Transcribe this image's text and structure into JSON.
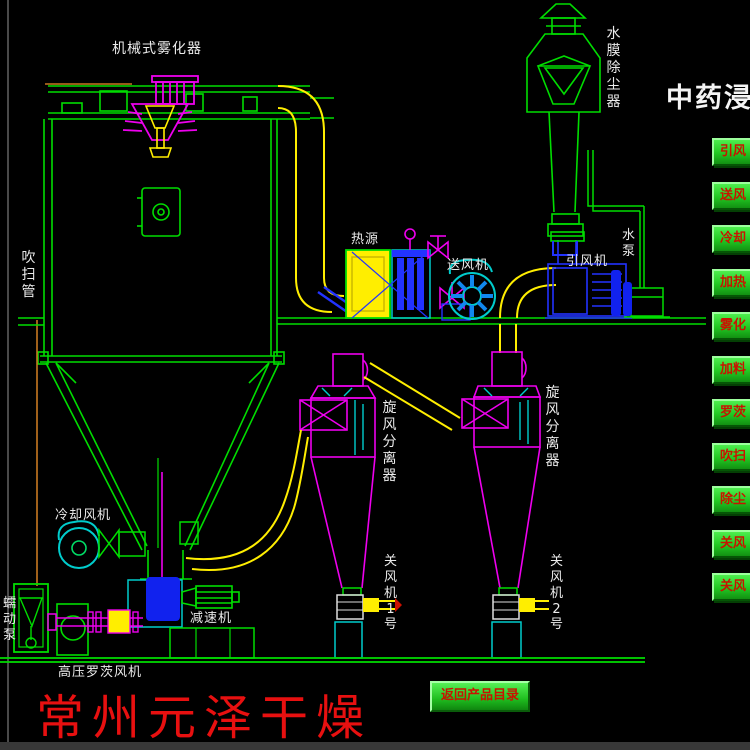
{
  "header": {
    "title": "中药浸膏"
  },
  "control_panel": {
    "items": [
      "引风",
      "送风",
      "冷却",
      "加热",
      "雾化",
      "加料",
      "罗茨",
      "吹扫",
      "除尘",
      "关风",
      "关风"
    ]
  },
  "equipment_labels": {
    "atomizer": "机械式雾化器",
    "dust_collector": "水膜除尘器",
    "purge_pipe": "吹扫管",
    "heat_source": "热源",
    "supply_fan": "送风机",
    "induced_fan": "引风机",
    "water_pump": "水泵",
    "cyclone1": "旋风分离器",
    "cyclone2": "旋风分离器",
    "cooling_fan": "冷却风机",
    "reducer": "减速机",
    "peristaltic_pump": "蠕动泵",
    "roots_blower": "高压罗茨风机",
    "airlock1": "关风机1号",
    "airlock2": "关风机2号"
  },
  "footer": {
    "company": "常州元泽干燥",
    "back_button": "返回产品目录"
  },
  "colors": {
    "line_green": "#00dd00",
    "magenta": "#ee00ee",
    "yellow": "#ffee00",
    "cyan": "#00cccc",
    "blue": "#2233ff",
    "orange": "#c87820",
    "button_green": "#22c822",
    "button_text_red": "#c81400",
    "company_red": "#e81010",
    "background": "#000000"
  }
}
